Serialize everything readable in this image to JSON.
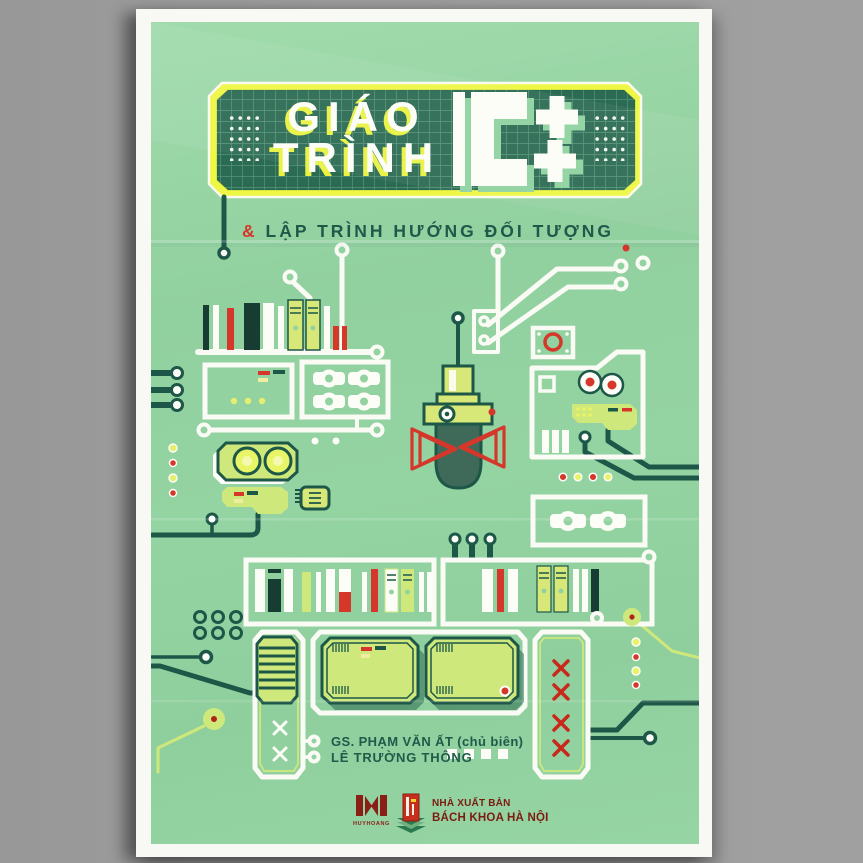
{
  "cover": {
    "title": {
      "line1": "GIÁO",
      "line2": "TRÌNH",
      "logo": "C++"
    },
    "subtitle": {
      "amp": "&",
      "text": " LẬP TRÌNH HƯỚNG ĐỐI TƯỢNG"
    },
    "authors": {
      "editor": "GS. PHẠM VĂN ẤT (chủ biên)",
      "coauthor": "LÊ TRƯỜNG THÔNG"
    },
    "publisher": {
      "huyhoang_label": "HUYHOANG",
      "nxb_line1": "NHÀ XUẤT BẢN",
      "nxb_line2": "BÁCH KHOA HÀ NỘI"
    },
    "colors": {
      "cover_green": "#93d2a1",
      "panel_dark_green": "#2b6a53",
      "frame_yellow": "#eef743",
      "accent_red": "#d5372b",
      "component_yellow_green": "#cfe87b",
      "ink_dark_green": "#1d5748",
      "subtitle_green": "#20584a",
      "publisher_maroon": "#7c1b10"
    },
    "icons": [
      "bookshelf-icon",
      "microphone-icon",
      "camera-icon",
      "robot-head-icon",
      "gamepad-icon",
      "chip-icon",
      "capacitor-icon",
      "screen-icon",
      "spool-box-icon",
      "circuit-trace",
      "publisher-logo-huyhoang",
      "publisher-logo-bachkhoa"
    ]
  }
}
